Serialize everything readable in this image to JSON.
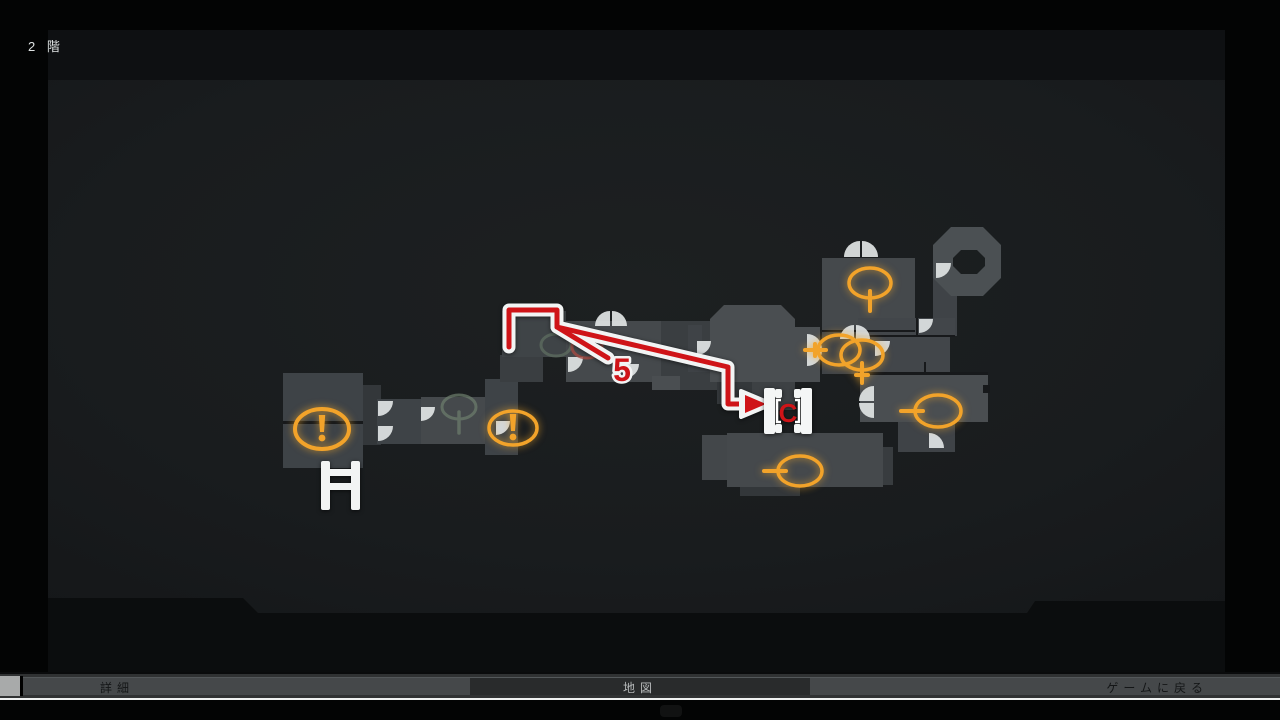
{
  "screen": {
    "floor_label": "2 階",
    "hint_glyph": "controller-hint"
  },
  "bottom_bar": {
    "left_tab": "詳細",
    "center_tab": "地図",
    "right_action": "ゲームに戻る"
  },
  "colors": {
    "accent_orange": "#f2a32a",
    "route_red": "#cf1418",
    "outline_white": "#f2f4f4",
    "door_white": "#dfe3e3",
    "room_default": "#3f4347",
    "wall_dark": "#17191b",
    "faded_green": "#64715f",
    "faded_red": "#a34b42"
  },
  "map": {
    "rooms": [
      [
        283,
        373,
        80,
        95,
        "#3e4347"
      ],
      [
        363,
        385,
        18,
        60,
        "#33373a"
      ],
      [
        377,
        399,
        44,
        45,
        "#3e4347"
      ],
      [
        421,
        397,
        64,
        47,
        "#45494c"
      ],
      [
        485,
        379,
        33,
        76,
        "#3e4347"
      ],
      [
        500,
        355,
        43,
        27,
        "#3a3e41"
      ],
      [
        502,
        311,
        64,
        46,
        "#3f4447"
      ],
      [
        566,
        321,
        99,
        61,
        "#45494c"
      ],
      [
        661,
        321,
        59,
        69,
        "#3a3e41"
      ],
      [
        652,
        376,
        28,
        14,
        "#4a4e51"
      ],
      [
        688,
        325,
        14,
        17,
        "#3f4347"
      ],
      [
        688,
        342,
        22,
        30,
        "#3f4347"
      ],
      [
        717,
        382,
        35,
        22,
        "#34383b"
      ],
      [
        752,
        382,
        43,
        28,
        "#3d4144"
      ],
      [
        702,
        435,
        25,
        45,
        "#43474a"
      ],
      [
        727,
        433,
        156,
        54,
        "#45494c"
      ],
      [
        740,
        487,
        60,
        9,
        "#33373a"
      ],
      [
        883,
        447,
        10,
        38,
        "#383c3f"
      ],
      [
        822,
        332,
        53,
        42,
        "#3f4347"
      ],
      [
        822,
        258,
        93,
        72,
        "#45494c"
      ],
      [
        933,
        272,
        24,
        64,
        "#3f4347"
      ],
      [
        858,
        318,
        97,
        17,
        "#42464a"
      ],
      [
        858,
        337,
        92,
        36,
        "#42464a"
      ],
      [
        860,
        375,
        128,
        47,
        "#4a4e51"
      ],
      [
        898,
        422,
        57,
        30,
        "#3f4347"
      ]
    ],
    "polys": [
      {
        "d": "M724 305 L781 305 L795 319 L795 327 L820 327 L820 382 L710 382 L710 319 Z",
        "fill": "#4a4e51"
      },
      {
        "d": "M951 227 L983 227 L1001 245 L1001 278 L983 296 L951 296 L933 278 L933 245 Z M961 250 L977 250 L985 258 L985 266 L977 274 L961 274 L953 266 L953 258 Z",
        "fill": "#4b5053",
        "evenodd": true
      }
    ],
    "walls": [
      [
        283,
        421,
        80,
        3
      ],
      [
        822,
        330,
        93,
        2
      ],
      [
        858,
        335,
        97,
        2
      ],
      [
        858,
        372,
        130,
        3
      ],
      [
        916,
        318,
        2,
        17
      ],
      [
        924,
        362,
        2,
        11
      ],
      [
        983,
        385,
        7,
        8
      ]
    ],
    "doors": [
      {
        "type": "single",
        "x": 378,
        "y": 401,
        "r": 15,
        "rot": 0
      },
      {
        "type": "single",
        "x": 378,
        "y": 426,
        "r": 15,
        "rot": 0
      },
      {
        "type": "single",
        "x": 421,
        "y": 407,
        "r": 14,
        "rot": 0
      },
      {
        "type": "single",
        "x": 496,
        "y": 421,
        "r": 14,
        "rot": 0
      },
      {
        "type": "single",
        "x": 568,
        "y": 357,
        "r": 15,
        "rot": 0
      },
      {
        "type": "single",
        "x": 625,
        "y": 364,
        "r": 14,
        "rot": 0
      },
      {
        "type": "single",
        "x": 697,
        "y": 341,
        "r": 14,
        "rot": 0
      },
      {
        "type": "single",
        "x": 919,
        "y": 319,
        "r": 14,
        "rot": 0
      },
      {
        "type": "single",
        "x": 936,
        "y": 263,
        "r": 15,
        "rot": 0
      },
      {
        "type": "single",
        "x": 875,
        "y": 341,
        "r": 15,
        "rot": 0
      },
      {
        "type": "single",
        "x": 929,
        "y": 448,
        "r": 15,
        "rot": -90
      },
      {
        "type": "petal-up",
        "x": 611,
        "y": 326,
        "r": 15
      },
      {
        "type": "petal-up",
        "x": 861,
        "y": 257,
        "r": 16
      },
      {
        "type": "petal-up",
        "x": 855,
        "y": 339,
        "r": 14
      },
      {
        "type": "petal-right",
        "x": 807,
        "y": 350,
        "r": 15
      },
      {
        "type": "petal-left",
        "x": 874,
        "y": 402,
        "r": 15
      }
    ],
    "icons": [
      {
        "type": "exclaim",
        "cx": 322,
        "cy": 429,
        "rx": 27,
        "ry": 20,
        "sw": 4
      },
      {
        "type": "exclaim",
        "cx": 513,
        "cy": 428,
        "rx": 24,
        "ry": 17,
        "sw": 3.5
      },
      {
        "type": "tail",
        "cx": 459,
        "cy": 407,
        "rx": 17,
        "ry": 12,
        "sw": 3,
        "dir": "down",
        "len": 14,
        "color": "#6e7f6e",
        "opacity": 0.7
      },
      {
        "type": "plain",
        "cx": 556,
        "cy": 345,
        "rx": 15,
        "ry": 11,
        "sw": 3,
        "color": "#5f6d60",
        "opacity": 0.75
      },
      {
        "type": "plain",
        "cx": 587,
        "cy": 347,
        "rx": 15,
        "ry": 11,
        "sw": 3,
        "color": "#a34b42",
        "opacity": 0.8
      },
      {
        "type": "tail",
        "cx": 870,
        "cy": 283,
        "rx": 21,
        "ry": 15,
        "sw": 3.5,
        "dir": "down",
        "len": 13,
        "accent": true
      },
      {
        "type": "tail",
        "cx": 839,
        "cy": 350,
        "rx": 21,
        "ry": 15,
        "sw": 3.5,
        "dir": "left",
        "len": 13,
        "tick": true,
        "accent": true
      },
      {
        "type": "tail",
        "cx": 862,
        "cy": 355,
        "rx": 21,
        "ry": 15,
        "sw": 3.5,
        "dir": "down",
        "len": 13,
        "tick": true,
        "accent": true
      },
      {
        "type": "tail",
        "cx": 938,
        "cy": 411,
        "rx": 23,
        "ry": 16,
        "sw": 3.5,
        "dir": "left",
        "len": 14,
        "accent": true
      },
      {
        "type": "tail",
        "cx": 800,
        "cy": 471,
        "rx": 22,
        "ry": 15,
        "sw": 3.5,
        "dir": "left",
        "len": 14,
        "accent": true
      }
    ],
    "ladder": {
      "rails": [
        [
          321,
          461,
          9,
          49
        ],
        [
          351,
          461,
          9,
          49
        ]
      ],
      "rungs": [
        [
          321,
          469,
          39,
          7
        ],
        [
          321,
          483,
          39,
          7
        ]
      ]
    },
    "route": {
      "points_main": "509,347 509,310 557,310 557,327 728,367 728,404 746,404",
      "points_branch": "557,327 608,358",
      "arrow_white": "741,391 772,404 741,417",
      "arrow_red": "745,395 766,404 745,413",
      "number_label": "5",
      "number_pos": [
        622,
        381
      ],
      "dest_label": "C",
      "cdoor_origin": [
        764,
        388
      ]
    }
  }
}
